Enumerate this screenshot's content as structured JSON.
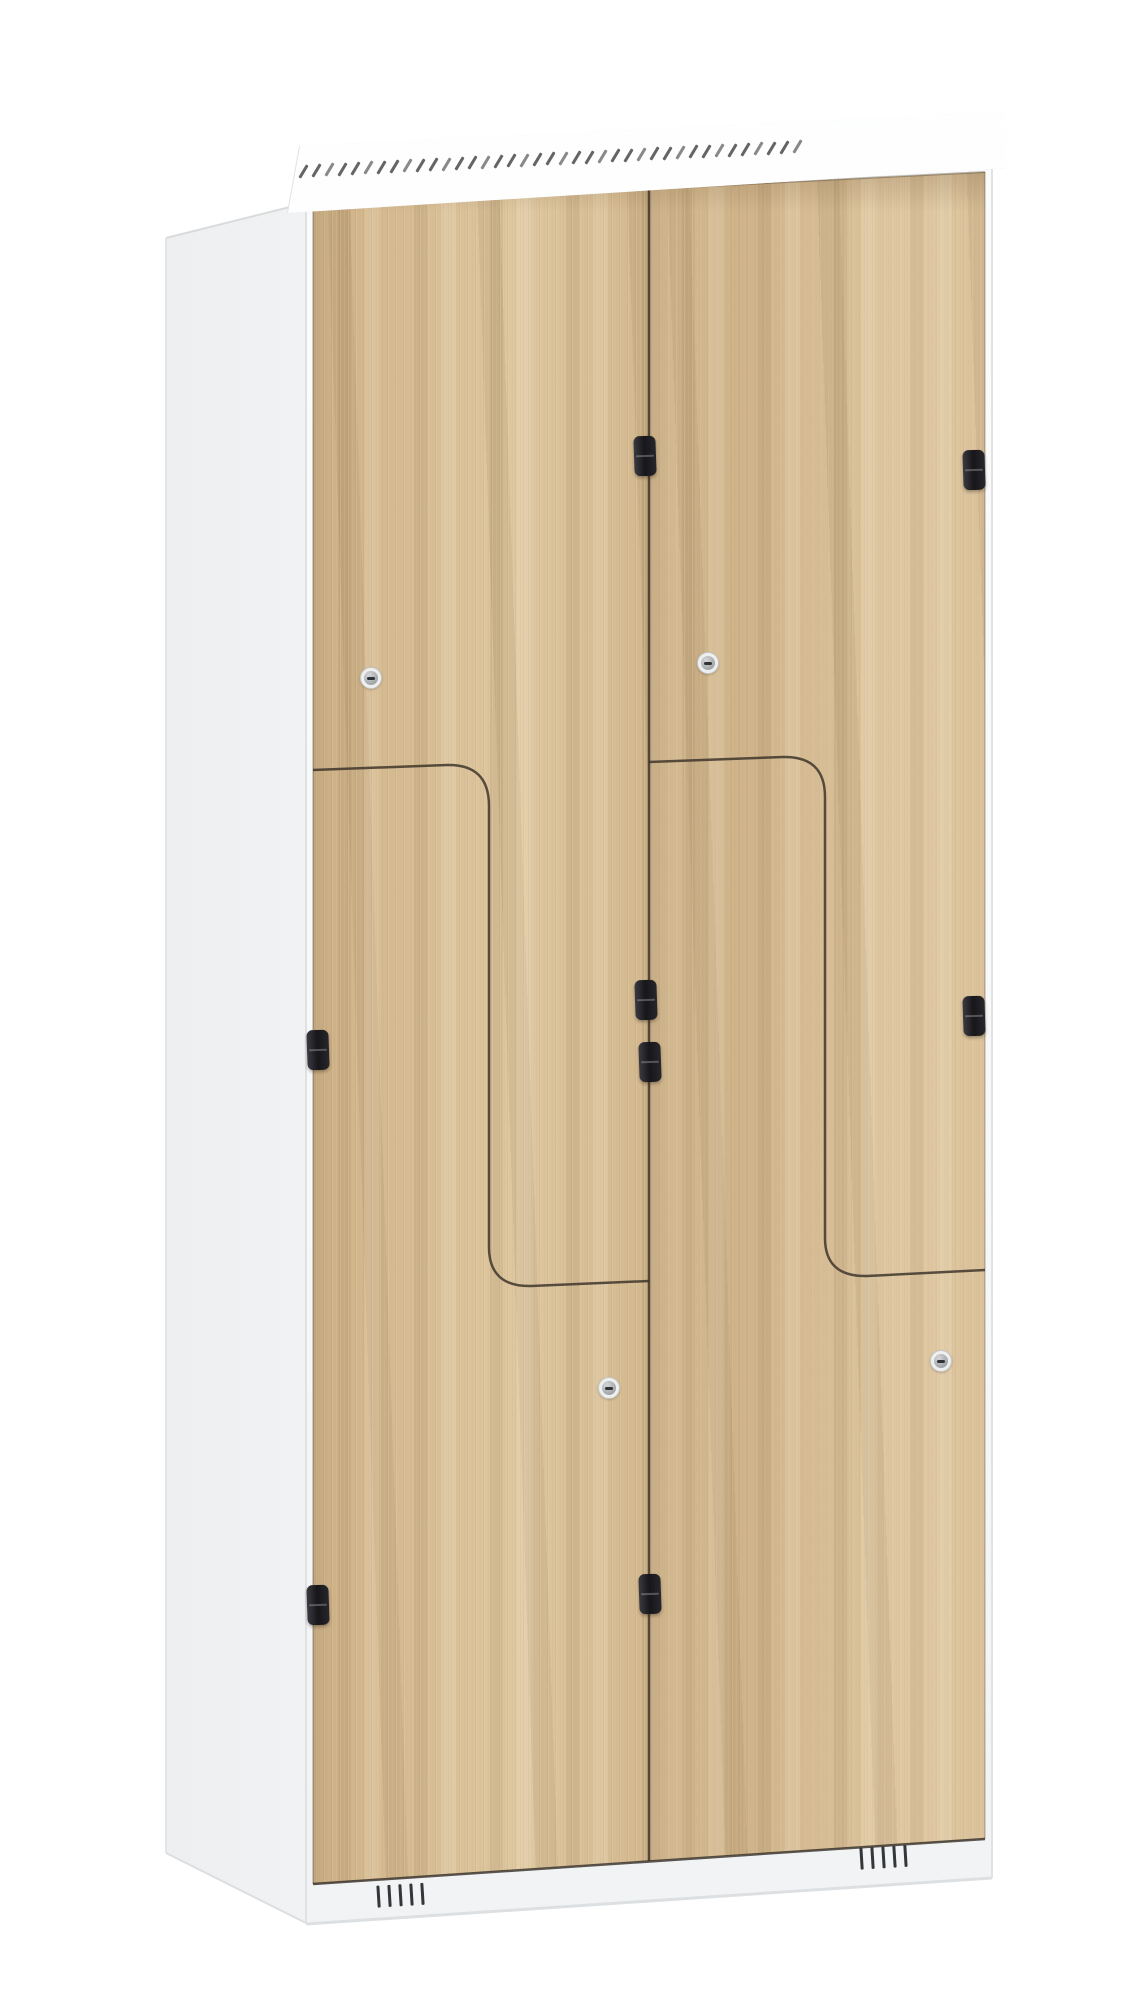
{
  "canvas": {
    "width": 1125,
    "height": 2000,
    "background": "#ffffff"
  },
  "palette": {
    "cabinet_white": "#f7f8f9",
    "side_shade": "#eceeef",
    "wood_base": "#d6ba90",
    "wood_streak_dark": "#b5946a",
    "wood_streak_light": "#ecd9b4",
    "seam_dark": "#4a443b",
    "hinge_black": "#1d1d21",
    "lock_ring": "#eef0f0",
    "lock_face": "#a3a6a9",
    "lock_slot": "#2f3236",
    "cap_dash": "#4a4a4a",
    "vent_slat": "#33363a",
    "edge_line": "#d8dadc"
  },
  "parts": {
    "top_cap": {
      "name": "sloped-roof-cap",
      "dash_count": 39,
      "dash_spacing": 13,
      "dash_start_x": 302,
      "dash_baseline_y": 170,
      "dash_slope": -0.049
    },
    "doors": [
      {
        "name": "upper-left-z-door"
      },
      {
        "name": "lower-left-z-door"
      },
      {
        "name": "upper-right-z-door"
      },
      {
        "name": "lower-right-z-door"
      }
    ],
    "hinges": [
      {
        "x": 645,
        "y": 456
      },
      {
        "x": 646,
        "y": 1000
      },
      {
        "x": 318,
        "y": 1050
      },
      {
        "x": 318,
        "y": 1605
      },
      {
        "x": 974,
        "y": 470
      },
      {
        "x": 974,
        "y": 1016
      },
      {
        "x": 650,
        "y": 1062
      },
      {
        "x": 650,
        "y": 1594
      }
    ],
    "locks": [
      {
        "x": 370,
        "y": 677
      },
      {
        "x": 707,
        "y": 662
      },
      {
        "x": 608,
        "y": 1387
      },
      {
        "x": 940,
        "y": 1360
      }
    ],
    "bottom_vents": [
      {
        "x": 377,
        "y": 1884,
        "slats": 5,
        "tilt": -3.5
      },
      {
        "x": 860,
        "y": 1846,
        "slats": 5,
        "tilt": -3.5
      }
    ]
  }
}
